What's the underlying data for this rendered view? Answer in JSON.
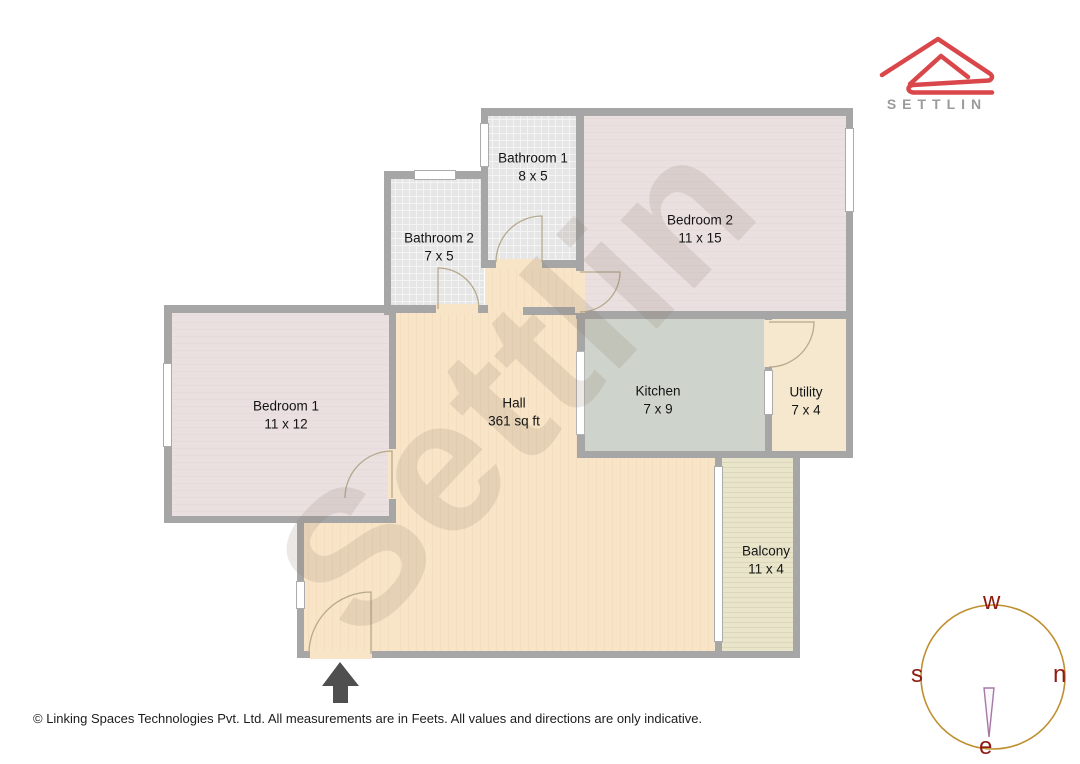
{
  "logo": {
    "brand": "SETTLIN"
  },
  "watermark": {
    "text": "Settlin"
  },
  "rooms": [
    {
      "id": "bathroom1",
      "name": "Bathroom 1",
      "dims": "8 x 5"
    },
    {
      "id": "bathroom2",
      "name": "Bathroom 2",
      "dims": "7 x 5"
    },
    {
      "id": "bedroom2",
      "name": "Bedroom 2",
      "dims": "11 x 15"
    },
    {
      "id": "bedroom1",
      "name": "Bedroom 1",
      "dims": "11 x 12"
    },
    {
      "id": "hall",
      "name": "Hall",
      "dims": "361 sq ft"
    },
    {
      "id": "kitchen",
      "name": "Kitchen",
      "dims": "7 x 9"
    },
    {
      "id": "utility",
      "name": "Utility",
      "dims": "7 x 4"
    },
    {
      "id": "balcony",
      "name": "Balcony",
      "dims": "11 x 4"
    }
  ],
  "compass": {
    "top": "w",
    "right": "n",
    "bottom": "e",
    "left": "s"
  },
  "footer": {
    "text": "© Linking Spaces Technologies Pvt. Ltd. All measurements are in Feets. All values and directions are only indicative."
  },
  "colors": {
    "wall": "#a6a6a6",
    "hall": "#f8e4c7",
    "bedroom": "#e9dede",
    "tile": "#e6e6e6",
    "kitchen": "#ced3cb",
    "utility": "#f6e8cf",
    "balcony": "#e9e5cb",
    "logo_red": "#d9474b",
    "brand_gray": "#9b9b9b",
    "compass_ring": "#bf8f2f",
    "compass_letters": "#8e1a12",
    "arrow": "#4f4f4f"
  }
}
